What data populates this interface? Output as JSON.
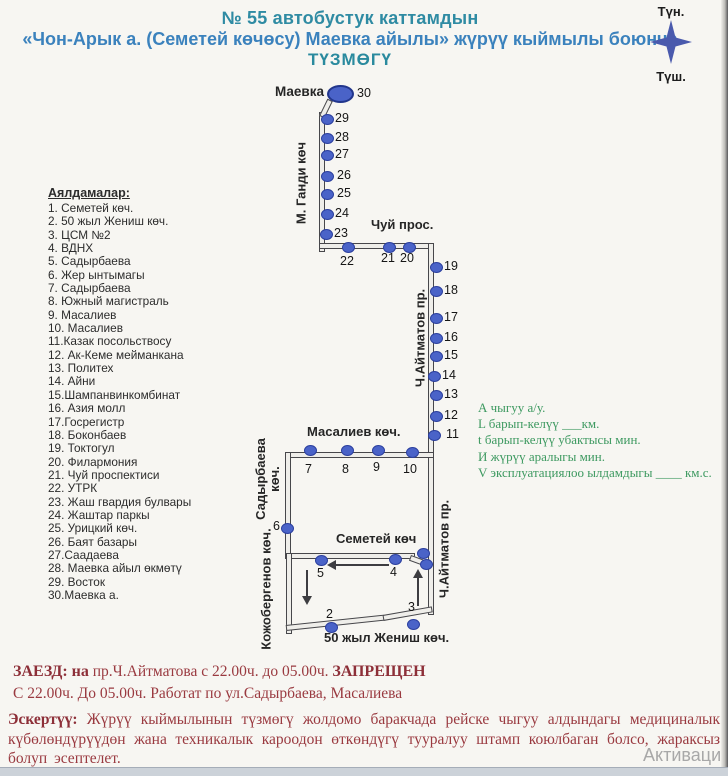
{
  "header": {
    "line1": "№ 55  автобустук каттамдын",
    "line2": "«Чон-Арык а. (Семетей көчөсу) Маевка айылы»  жүрүү кыймылы боюнча",
    "line3": "ТҮЗМӨГҮ"
  },
  "compass": {
    "north": "Түн.",
    "south": "Түш."
  },
  "stops_list": {
    "title": "Аялдамалар:",
    "items": [
      "1. Семетей көч.",
      "2. 50 жыл Жениш көч.",
      "3. ЦСМ №2",
      "4. ВДНХ",
      "5. Садырбаева",
      "6. Жер ынтымагы",
      "7. Садырбаева",
      "8. Южный магистраль",
      "9. Масалиев",
      "10. Масалиев",
      "11.Казак посольствосу",
      "12. Ак-Кеме мейманкана",
      "13. Политех",
      "14. Айни",
      "15.Шампанвинкомбинат",
      "16. Азия молл",
      "17.Госрегистр",
      "18. Боконбаев",
      "19. Токтогул",
      "20. Филармония",
      "21. Чуй проспектиси",
      "22. УТРК",
      "23. Жаш гвардия булвары",
      "24. Жаштар паркы",
      "25. Урицкий көч.",
      "26. Баят базары",
      "27.Саадаева",
      "28. Маевка айыл өкмөтү",
      "29. Восток",
      "30.Маевка а."
    ]
  },
  "map": {
    "terminal": {
      "label": "Маевка а.",
      "number": "30"
    },
    "street_labels": {
      "gandhi": "М. Ганди көч",
      "chui": "Чуй прос.",
      "aitmatov_upper": "Ч.Айтматов пр.",
      "aitmatov_lower": "Ч.Айтматов пр.",
      "masaliev": "Масалиев көч.",
      "sadyrbaeva_line1": "Садырбаева",
      "sadyrbaeva_line2": "көч.",
      "semetei": "Семетей көч",
      "kozhobergenov": "Кожобергенов көч.",
      "zhenish": "50 жыл Жениш көч."
    },
    "stops": [
      {
        "n": "29",
        "x": 327,
        "y": 119,
        "lx": 335,
        "ly": 111
      },
      {
        "n": "28",
        "x": 327,
        "y": 138,
        "lx": 335,
        "ly": 130
      },
      {
        "n": "27",
        "x": 327,
        "y": 155,
        "lx": 335,
        "ly": 147
      },
      {
        "n": "26",
        "x": 327,
        "y": 176,
        "lx": 337,
        "ly": 168
      },
      {
        "n": "25",
        "x": 327,
        "y": 194,
        "lx": 337,
        "ly": 186
      },
      {
        "n": "24",
        "x": 327,
        "y": 214,
        "lx": 335,
        "ly": 206
      },
      {
        "n": "23",
        "x": 326,
        "y": 234,
        "lx": 334,
        "ly": 226
      },
      {
        "n": "22",
        "x": 348,
        "y": 247,
        "lx": 340,
        "ly": 254
      },
      {
        "n": "21",
        "x": 389,
        "y": 247,
        "lx": 381,
        "ly": 251
      },
      {
        "n": "20",
        "x": 409,
        "y": 247,
        "lx": 400,
        "ly": 251
      },
      {
        "n": "19",
        "x": 436,
        "y": 267,
        "lx": 444,
        "ly": 259
      },
      {
        "n": "18",
        "x": 436,
        "y": 291,
        "lx": 444,
        "ly": 283
      },
      {
        "n": "17",
        "x": 436,
        "y": 318,
        "lx": 444,
        "ly": 310
      },
      {
        "n": "16",
        "x": 436,
        "y": 338,
        "lx": 444,
        "ly": 330
      },
      {
        "n": "15",
        "x": 436,
        "y": 356,
        "lx": 444,
        "ly": 348
      },
      {
        "n": "14",
        "x": 434,
        "y": 376,
        "lx": 442,
        "ly": 368
      },
      {
        "n": "13",
        "x": 436,
        "y": 395,
        "lx": 444,
        "ly": 387
      },
      {
        "n": "12",
        "x": 436,
        "y": 416,
        "lx": 444,
        "ly": 408
      },
      {
        "n": "11",
        "x": 434,
        "y": 435,
        "lx": 446,
        "ly": 427
      },
      {
        "n": "10",
        "x": 412,
        "y": 452,
        "lx": 403,
        "ly": 462
      },
      {
        "n": "9",
        "x": 378,
        "y": 450,
        "lx": 373,
        "ly": 460
      },
      {
        "n": "8",
        "x": 347,
        "y": 450,
        "lx": 342,
        "ly": 462
      },
      {
        "n": "7",
        "x": 310,
        "y": 450,
        "lx": 305,
        "ly": 462
      },
      {
        "n": "6",
        "x": 287,
        "y": 528,
        "lx": 273,
        "ly": 519
      },
      {
        "n": "5",
        "x": 321,
        "y": 560,
        "lx": 317,
        "ly": 566
      },
      {
        "n": "4",
        "x": 395,
        "y": 559,
        "lx": 390,
        "ly": 565
      },
      {
        "n": "",
        "x": 423,
        "y": 553,
        "lx": 0,
        "ly": 0
      },
      {
        "n": "",
        "x": 426,
        "y": 564,
        "lx": 0,
        "ly": 0
      },
      {
        "n": "3",
        "x": 413,
        "y": 624,
        "lx": 408,
        "ly": 600
      },
      {
        "n": "2",
        "x": 331,
        "y": 627,
        "lx": 326,
        "ly": 607
      }
    ]
  },
  "annotations": {
    "lines": [
      "А чыгуу  а/у.",
      "L барып-келүү  ___км.",
      "t барып-келүү убактысы    мин.",
      "И жүрүү аралыгы      мин.",
      "V эксплуатациялоо ылдамдыгы ____ км.с."
    ]
  },
  "notice": {
    "bold1": "ЗАЕЗД: на",
    "mid": "  пр.Ч.Айтматова с 22.00ч. до 05.00ч. ",
    "bold2": "ЗАПРЕЩЕН",
    "line2": "С 22.00ч. До 05.00ч. Работат по ул.Садырбаева, Масалиева"
  },
  "footer": {
    "bold": "Эскертүү:",
    "text": " Жүрүү кыймылынын түзмөгү жолдомо баракчада рейске чыгуу алдындагы медициналык күбөлөндүрүүдөн жана техникалык кароодон өткөндүгү тууралуу штамп коюлбаган болсо, жараксыз болуп эсептелет."
  },
  "watermark": "Активаци",
  "colors": {
    "accent_teal": "#2f8ba3",
    "accent_blue": "#3b82bd",
    "green": "#3d9960",
    "red": "#9a3a40",
    "dot_blue": "#4a63c8",
    "road": "#47474b",
    "compass": "#4a5aad"
  }
}
